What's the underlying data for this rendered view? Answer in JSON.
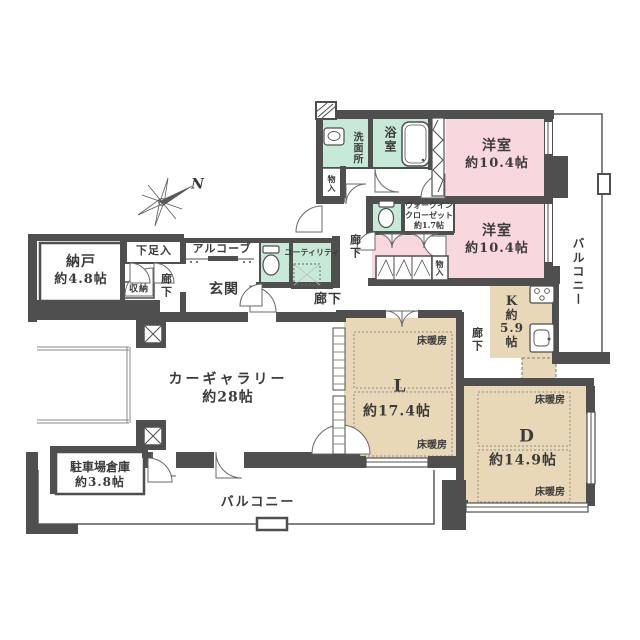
{
  "compass": {
    "north": "N"
  },
  "shared": {
    "hallway": "廊下",
    "floor_heating": "床暖房",
    "storage_small": "物入",
    "balcony": "バルコニー"
  },
  "rooms": {
    "storeroom": {
      "name": "納戸",
      "area": "約4.8帖"
    },
    "shoe_cabinet": {
      "name": "下足入"
    },
    "closet": {
      "name": "収納"
    },
    "alcove": {
      "name": "アルコーブ"
    },
    "entrance": {
      "name": "玄関"
    },
    "utility": {
      "name": "ユーティリティ"
    },
    "washroom": {
      "name": "洗面所"
    },
    "bathroom": {
      "name": "浴室"
    },
    "walk_in_closet": {
      "name_line1": "ウォークイン",
      "name_line2": "クローゼット",
      "area": "約1.7帖"
    },
    "bedroom_top": {
      "name": "洋室",
      "area": "約10.4帖"
    },
    "bedroom_bottom": {
      "name": "洋室",
      "area": "約10.4帖"
    },
    "kitchen": {
      "name": "K",
      "prefix": "約",
      "value": "5.9",
      "unit": "帖"
    },
    "living": {
      "name": "L",
      "area": "約17.4帖"
    },
    "dining": {
      "name": "D",
      "area": "約14.9帖"
    },
    "car_gallery": {
      "name": "カーギャラリー",
      "area": "約28帖"
    },
    "garage_storage": {
      "name": "駐車場倉庫",
      "area": "約3.8帖"
    }
  },
  "colors": {
    "wall": "#4f4f4f",
    "bedroom_pink": "#f8d7de",
    "wet_area_green": "#c7e9d7",
    "living_tan": "#e8d8b8",
    "text": "#3b3b3b"
  }
}
